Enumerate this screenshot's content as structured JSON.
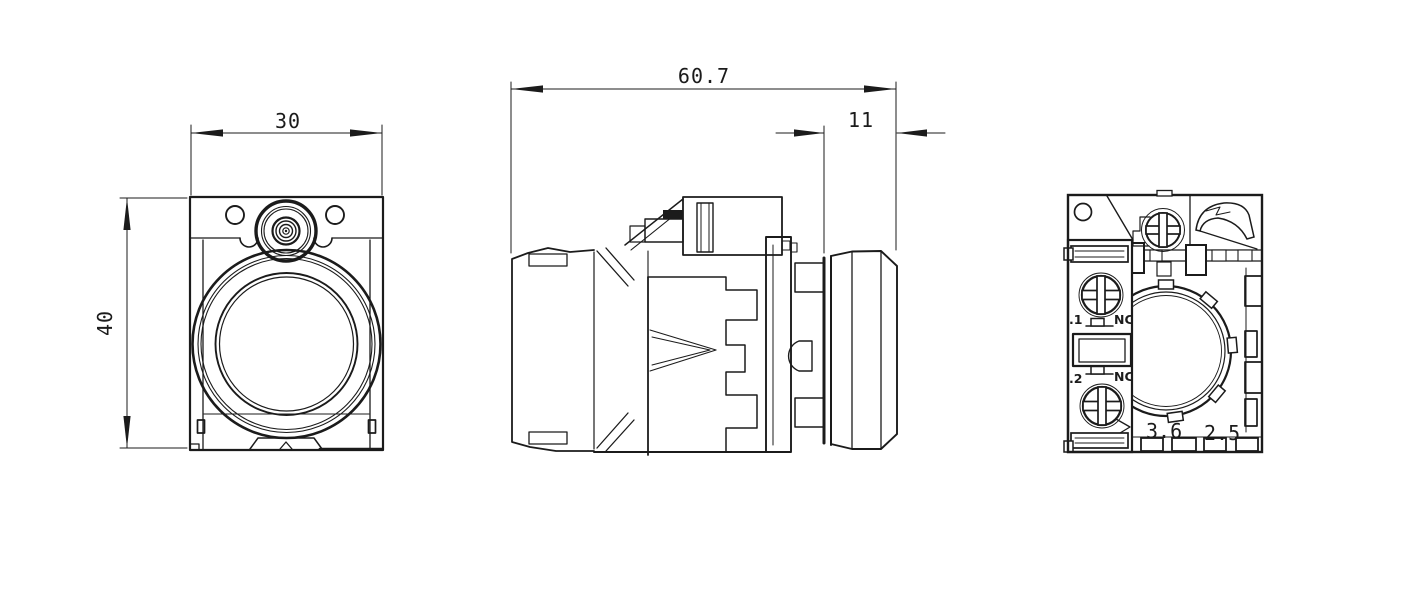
{
  "colors": {
    "line": "#1b1b1b",
    "background": "#ffffff"
  },
  "drawing": {
    "dimensions": {
      "front_width": "30",
      "front_height": "40",
      "overall_depth": "60.7",
      "cap_depth": "11"
    },
    "rear_view": {
      "terminal_1_label": ".1",
      "terminal_1_contact": "NC",
      "terminal_2_label": ".2",
      "terminal_2_contact": "NC",
      "marking_left": "3.6",
      "marking_right": "2.5"
    }
  }
}
